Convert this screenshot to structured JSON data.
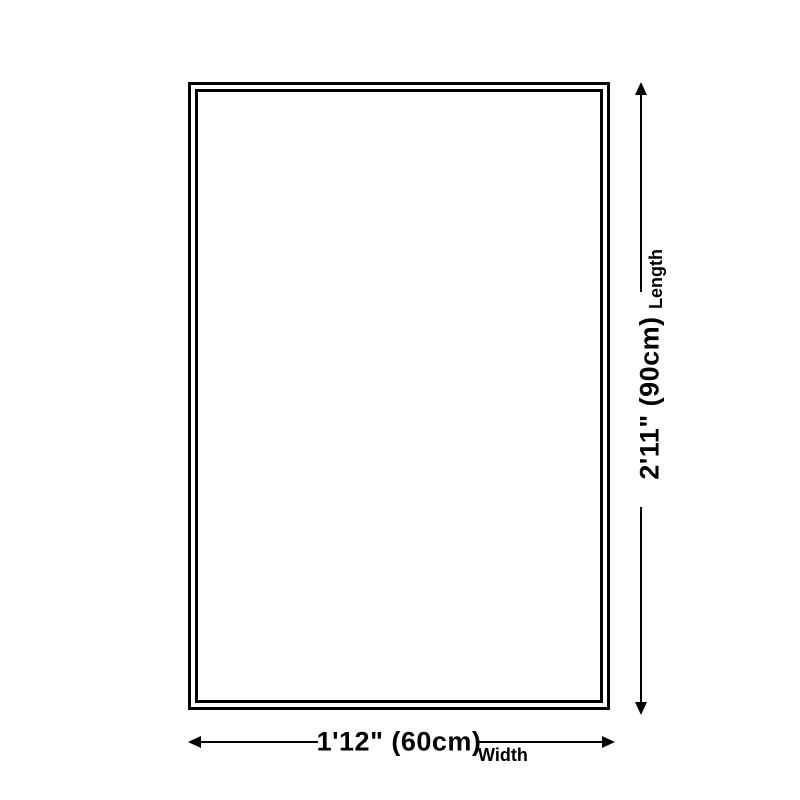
{
  "page": {
    "background_color": "#ffffff",
    "line_color": "#000000",
    "text_color": "#000000"
  },
  "diagram": {
    "length": {
      "value": "2'11\" (90cm)",
      "axis_label": "Length"
    },
    "width": {
      "value": "1'12\" (60cm)",
      "axis_label": "Width"
    },
    "icons": {
      "up": "arrow-up",
      "down": "arrow-down",
      "left": "arrow-left",
      "right": "arrow-right"
    }
  }
}
